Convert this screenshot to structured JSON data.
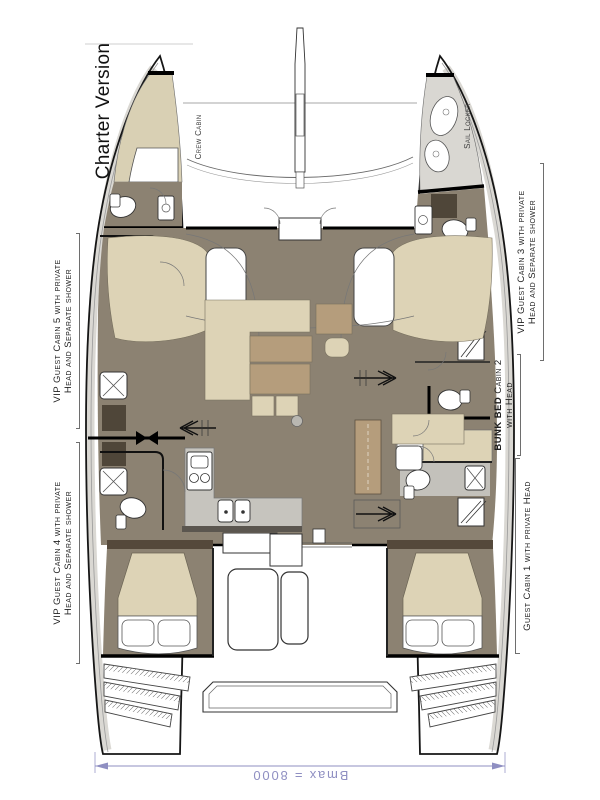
{
  "title": {
    "text": "Charter Version"
  },
  "plan": {
    "annotations": {
      "crew_cabin": "Crew Cabin",
      "sail_locker": "Sail Locker"
    },
    "cabins": [
      {
        "id": "cabin5",
        "line1": "VIP Guest Cabin 5 with private",
        "line2": "Head and Separate shower"
      },
      {
        "id": "cabin4",
        "line1": "VIP Guest Cabin 4 with private",
        "line2": "Head and Separate shower"
      },
      {
        "id": "cabin3",
        "line1": "VIP Guest Cabin 3 with private",
        "line2": "Head and Separate shower"
      },
      {
        "id": "cabin2",
        "bold": "BUNK BED",
        "rest": " Cabin 2",
        "line2": "with Head"
      },
      {
        "id": "cabin1",
        "line1": "Guest Cabin 1 with private Head"
      }
    ],
    "dimension": {
      "text": "Bmax = 8000"
    }
  },
  "colors": {
    "floor": "#8c8272",
    "bed": "#ddd3b6",
    "bow_bed": "#d9d0b4",
    "table": "#b59d7c",
    "dark_cabinet": "#4f4639",
    "deck_gray": "#d9d7d2",
    "galley_gray": "#c6c4be",
    "head_gray": "#c3c1bb",
    "dimension_blue": "#8f8fc2",
    "line": "#1a1a1a"
  }
}
